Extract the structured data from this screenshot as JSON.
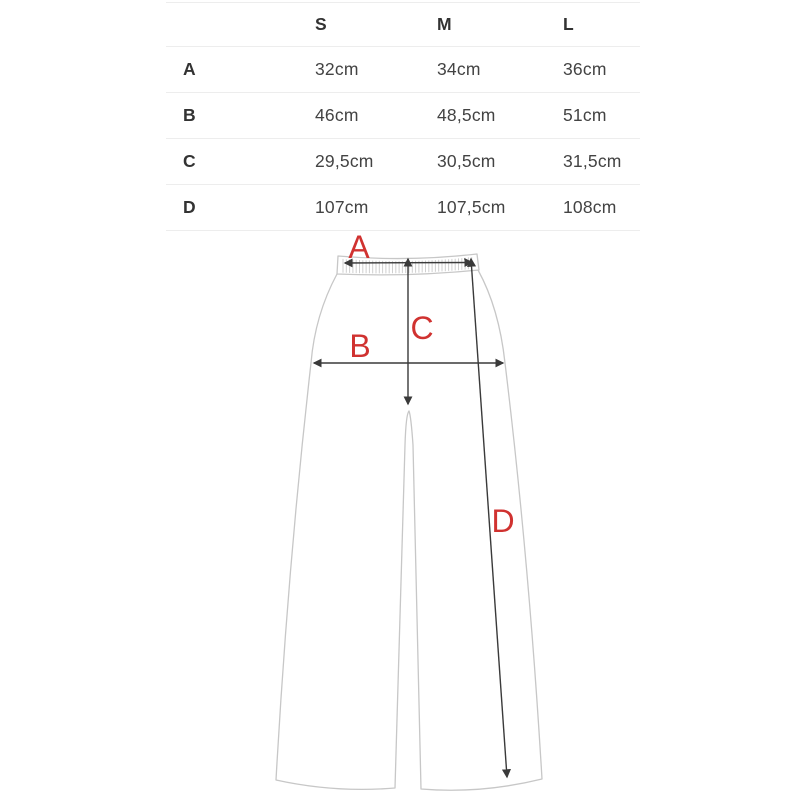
{
  "size_table": {
    "headers": [
      "S",
      "M",
      "L"
    ],
    "rows": [
      {
        "label": "A",
        "values": [
          "32cm",
          "34cm",
          "36cm"
        ]
      },
      {
        "label": "B",
        "values": [
          "46cm",
          "48,5cm",
          "51cm"
        ]
      },
      {
        "label": "C",
        "values": [
          "29,5cm",
          "30,5cm",
          "31,5cm"
        ]
      },
      {
        "label": "D",
        "values": [
          "107cm",
          "107,5cm",
          "108cm"
        ]
      }
    ]
  },
  "diagram": {
    "type": "pants-measurement-diagram",
    "labels": [
      {
        "id": "A",
        "text": "A"
      },
      {
        "id": "B",
        "text": "B"
      },
      {
        "id": "C",
        "text": "C"
      },
      {
        "id": "D",
        "text": "D"
      }
    ]
  },
  "colors": {
    "accent_red": "#d03230",
    "measure_line": "#3a3a3a",
    "garment_outline": "#c7c7c7",
    "table_text": "#3e3e3e",
    "divider": "#ededed"
  }
}
